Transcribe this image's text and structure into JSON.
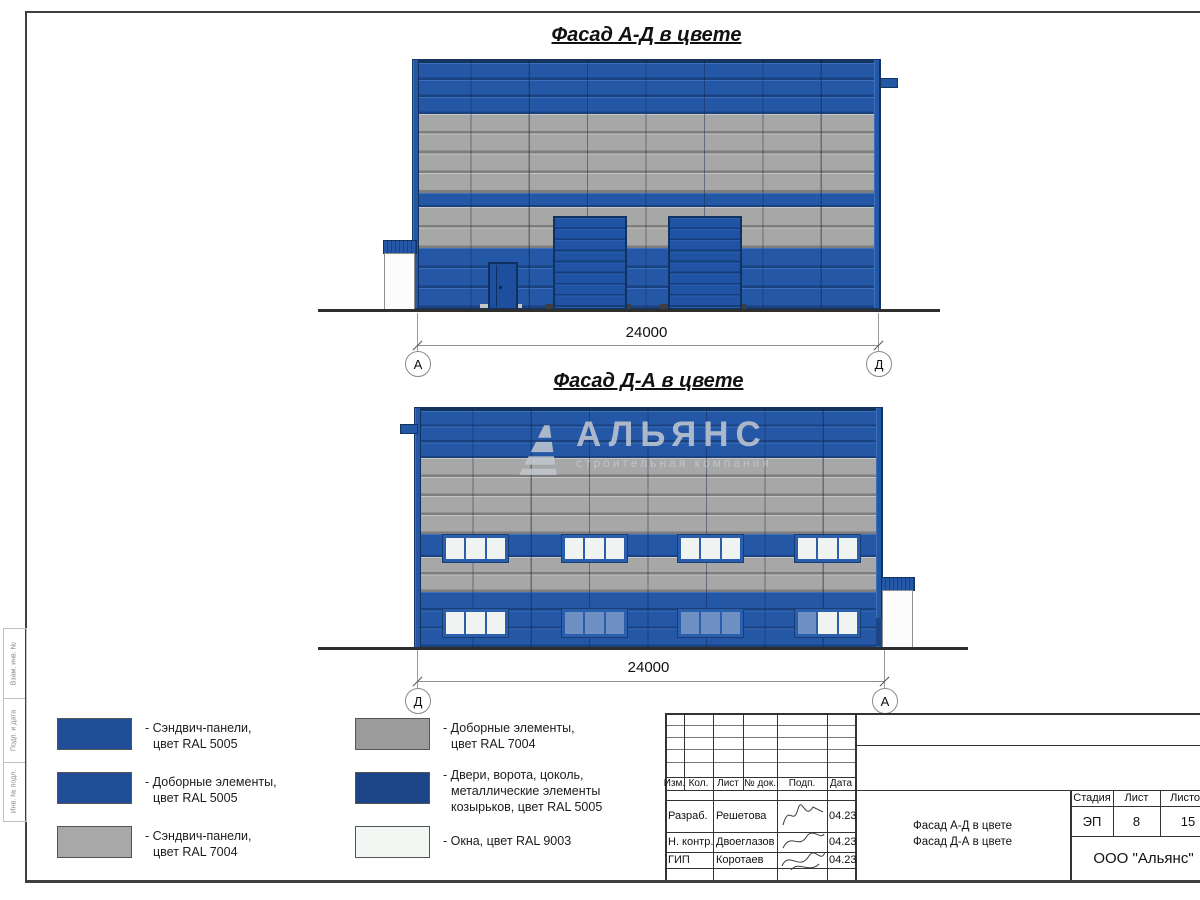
{
  "colors": {
    "panel_blue": "#2457A6",
    "panel_gray": "#A7A7A7",
    "door_navy": "#1B4586",
    "window_white": "#EFF3F1",
    "window_blue": "#6E90C2"
  },
  "facade1": {
    "title": "Фасад А-Д в цвете",
    "dimension": "24000",
    "axis_left": "А",
    "axis_right": "Д"
  },
  "facade2": {
    "title": "Фасад Д-А в цвете",
    "dimension": "24000",
    "axis_left": "Д",
    "axis_right": "А",
    "watermark": {
      "name": "АЛЬЯНС",
      "tagline": "строительная компания"
    },
    "windows": {
      "xs": [
        28,
        147,
        263,
        380
      ],
      "width": 59,
      "upper": {
        "y": 127,
        "h": 21,
        "panes": [
          [
            "w",
            "w",
            "w"
          ],
          [
            "w",
            "w",
            "w"
          ],
          [
            "w",
            "w",
            "w"
          ],
          [
            "w",
            "w",
            "w"
          ]
        ]
      },
      "lower": {
        "y": 201,
        "h": 22,
        "panes": [
          [
            "w",
            "w",
            "w"
          ],
          [
            "b",
            "b",
            "b"
          ],
          [
            "b",
            "b",
            "b"
          ],
          [
            "b",
            "w",
            "w"
          ]
        ]
      }
    }
  },
  "legend": {
    "items": [
      {
        "color": "#1F4E96",
        "lines": [
          "- Сэндвич-панели,",
          "цвет RAL 5005"
        ]
      },
      {
        "color": "#1F4E96",
        "lines": [
          "- Доборные элементы,",
          "цвет RAL 5005"
        ]
      },
      {
        "color": "#A8A8A8",
        "lines": [
          "- Сэндвич-панели,",
          "цвет RAL 7004"
        ]
      },
      {
        "color": "#9B9B9B",
        "lines": [
          "- Доборные элементы,",
          "цвет RAL 7004"
        ]
      },
      {
        "color": "#1B4586",
        "lines": [
          "- Двери, ворота, цоколь,",
          "металлические элементы",
          "козырьков, цвет RAL 5005"
        ]
      },
      {
        "color": "#F2F7F3",
        "lines": [
          "- Окна, цвет RAL 9003"
        ]
      }
    ]
  },
  "title_block": {
    "cols": [
      "Изм.",
      "Кол.",
      "Лист",
      "№ док.",
      "Подп.",
      "Дата"
    ],
    "rows": [
      {
        "role": "Разраб.",
        "name": "Решетова",
        "date": "04.23"
      },
      {
        "role": "Н. контр.",
        "name": "Двоеглазов",
        "date": "04.23"
      },
      {
        "role": "ГИП",
        "name": "Коротаев",
        "date": "04.23"
      }
    ],
    "doc_lines": [
      "Фасад А-Д в цвете",
      "Фасад Д-А в цвете"
    ],
    "stage_label": "Стадия",
    "sheet_label": "Лист",
    "sheets_label": "Листов",
    "stage": "ЭП",
    "sheet": "8",
    "sheets": "15",
    "company": "ООО \"Альянс\""
  },
  "margin_labels": [
    "Взам. инв. №",
    "Подп. и дата",
    "Инв. № подл."
  ]
}
